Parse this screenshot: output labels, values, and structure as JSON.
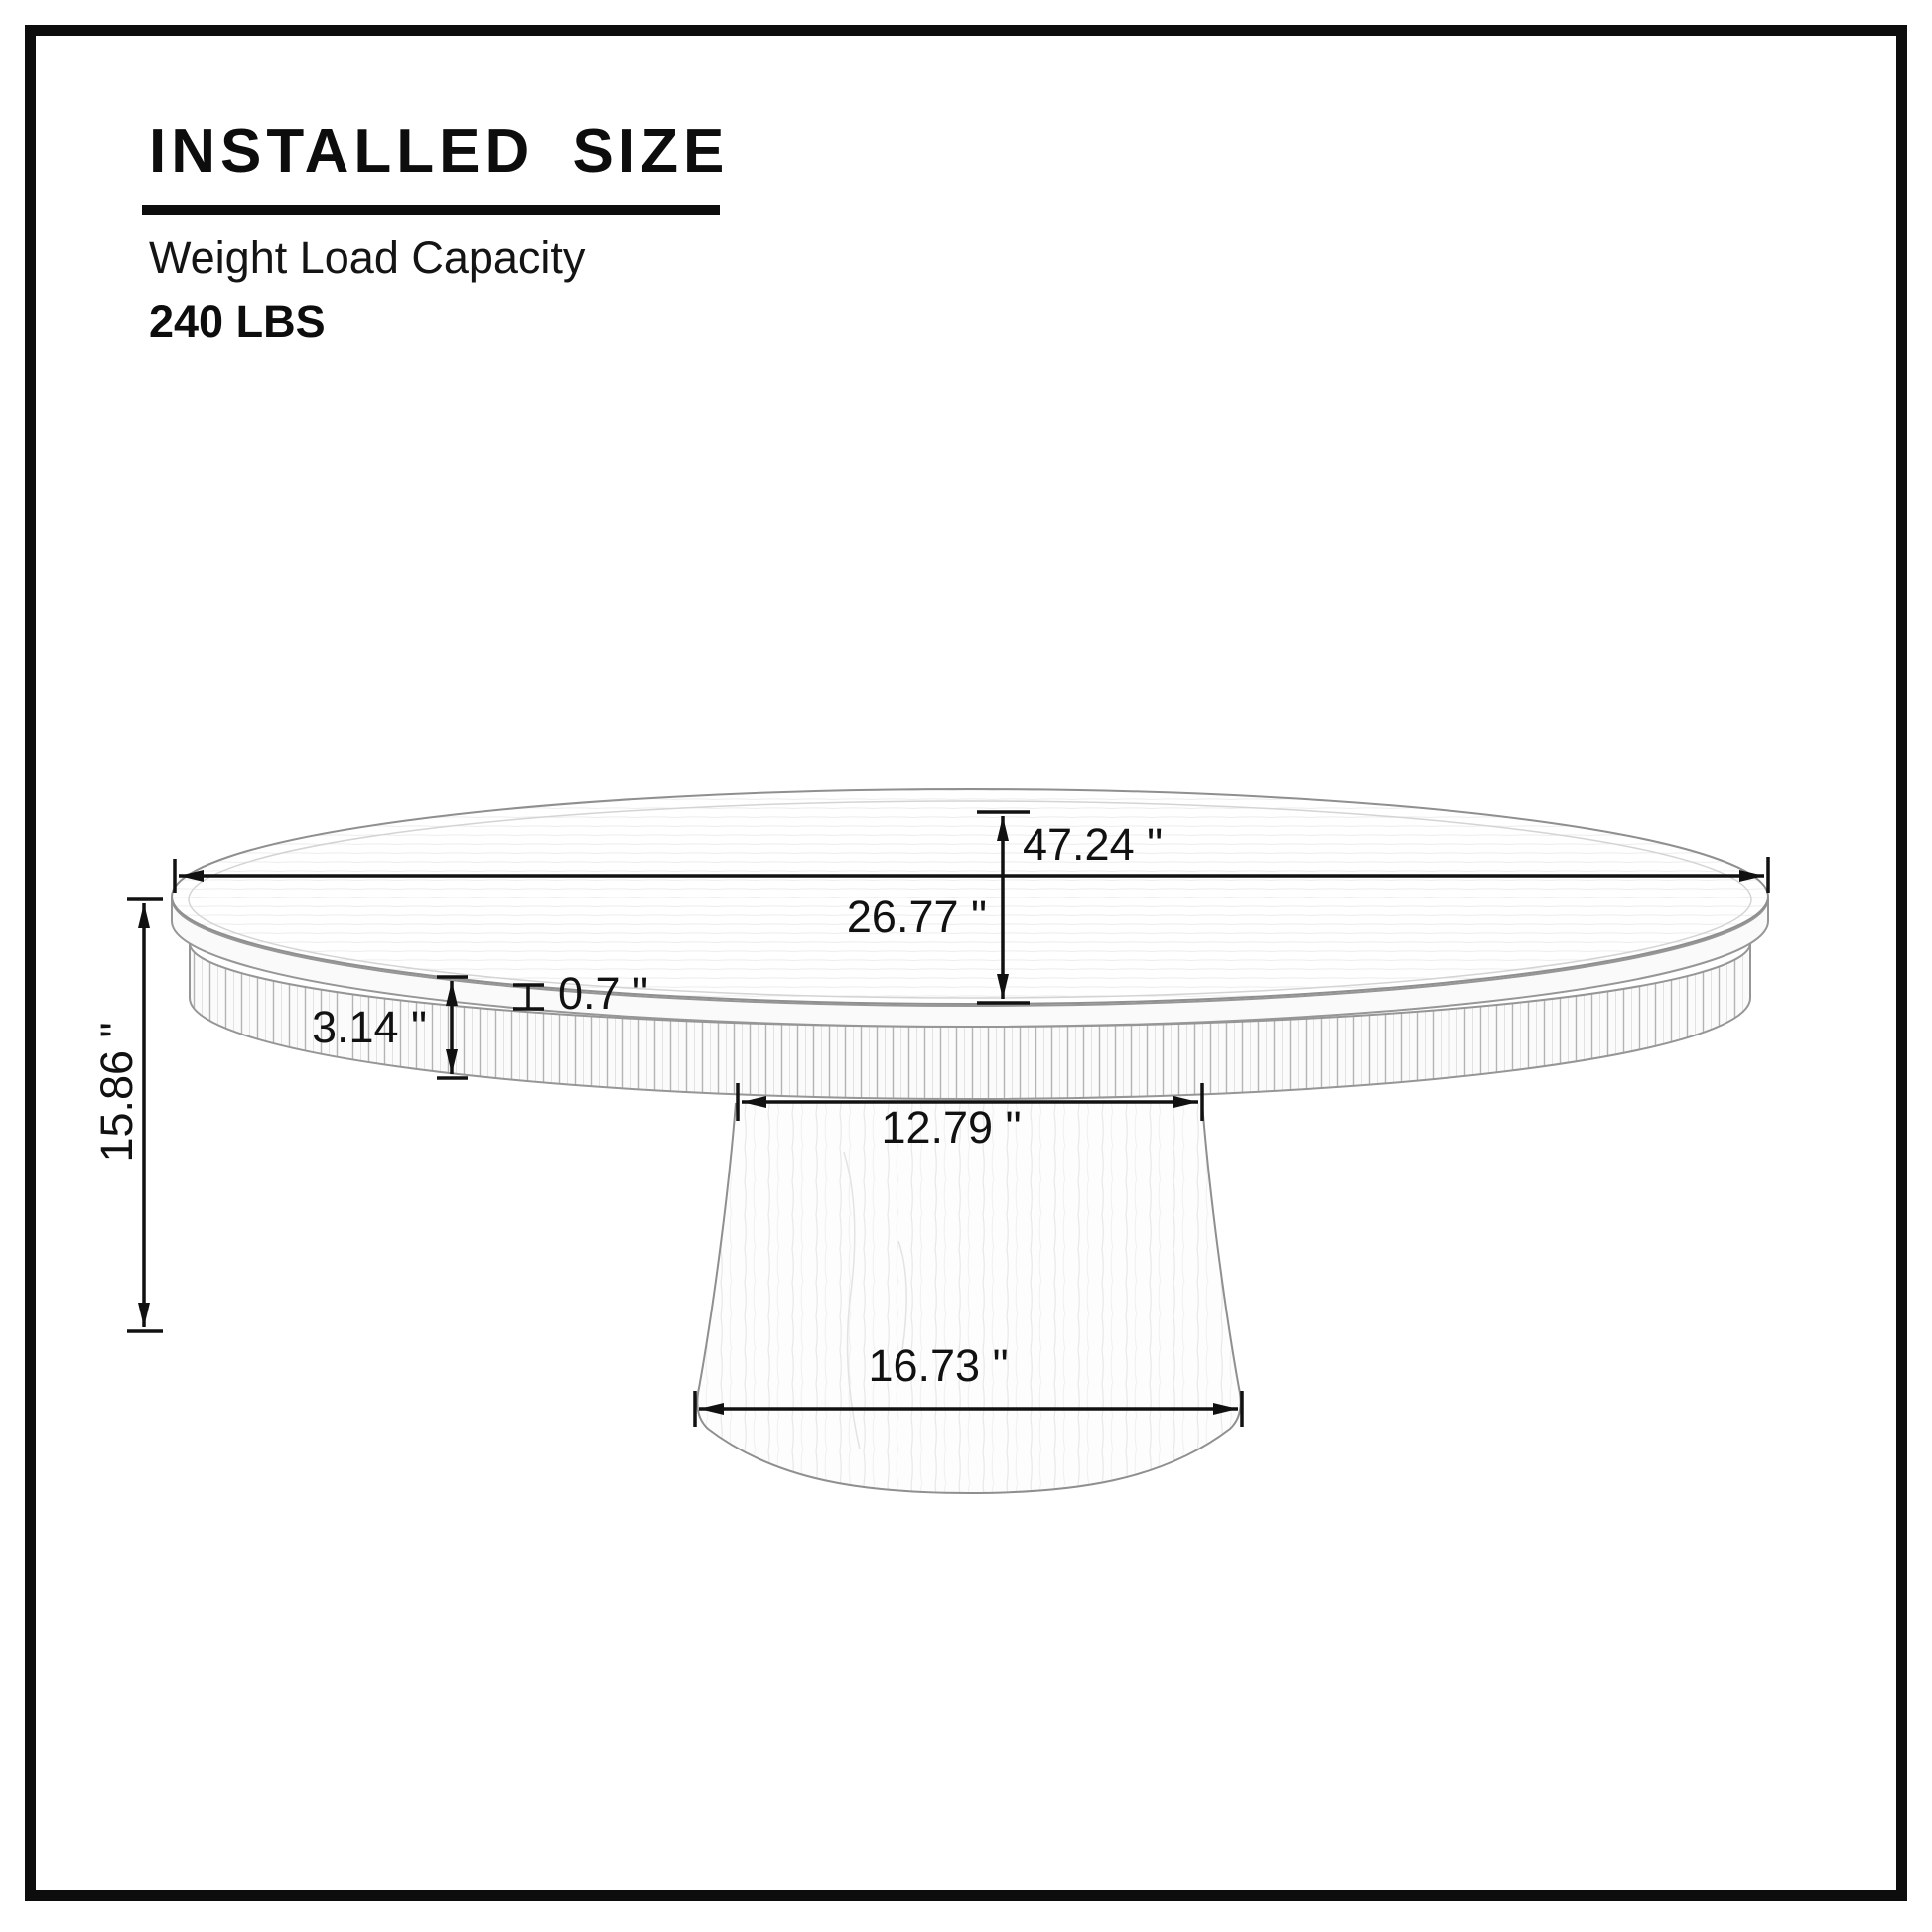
{
  "header": {
    "title": "INSTALLED SIZE",
    "subtitle": "Weight Load Capacity",
    "capacity": "240 LBS"
  },
  "diagram": {
    "dimensions": {
      "top_diameter": {
        "label": "47.24 \""
      },
      "top_depth": {
        "label": "26.77 \""
      },
      "top_thickness": {
        "label": "0.7 \""
      },
      "apron_height": {
        "label": "3.14 \""
      },
      "overall_height": {
        "label": "15.86 \""
      },
      "pedestal_top_width": {
        "label": "12.79 \""
      },
      "pedestal_base_width": {
        "label": "16.73 \""
      }
    }
  },
  "colors": {
    "frame_border": "#0d0d0d",
    "dimension_line": "#111111",
    "drawing_stroke": "#8f8f8f",
    "background": "#ffffff"
  }
}
